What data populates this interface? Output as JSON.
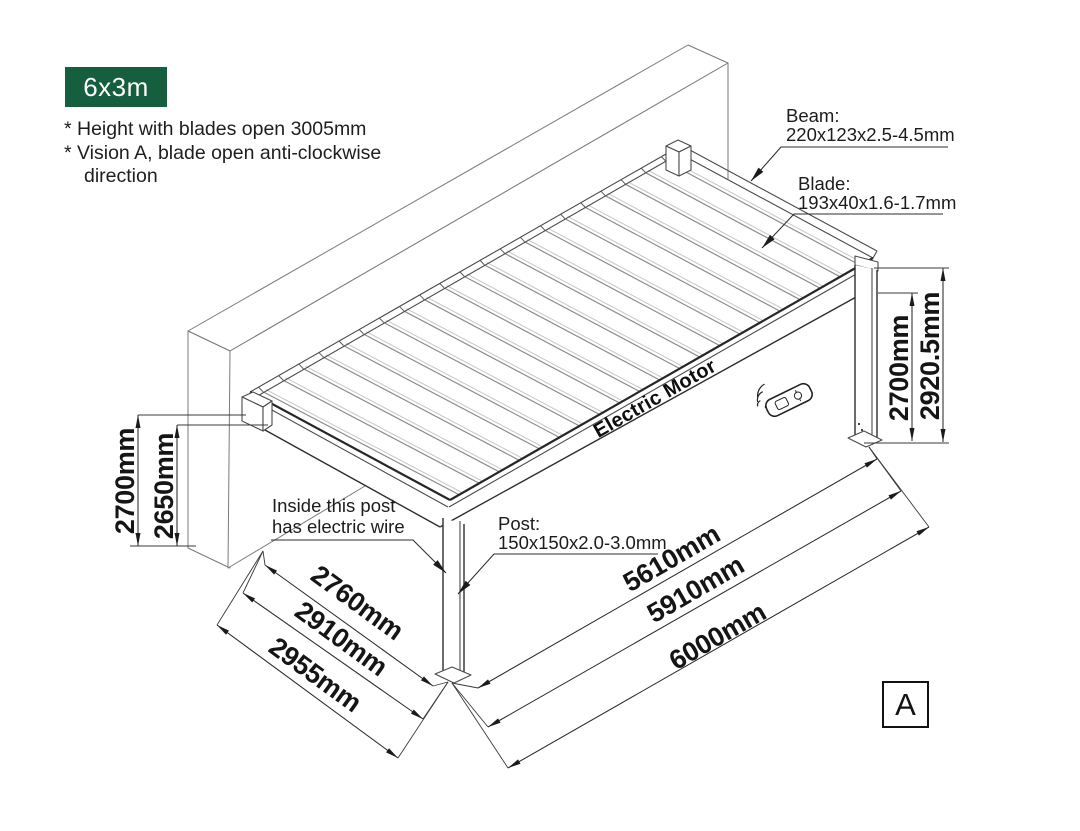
{
  "badge": {
    "label": "6x3m"
  },
  "notes": {
    "line1": "* Height with blades open 3005mm",
    "line2": "* Vision A, blade open anti-clockwise",
    "line3": "direction"
  },
  "callouts": {
    "beam_title": "Beam:",
    "beam_spec": "220x123x2.5-4.5mm",
    "blade_title": "Blade:",
    "blade_spec": "193x40x1.6-1.7mm",
    "post_title": "Post:",
    "post_spec": "150x150x2.0-3.0mm",
    "wire_line1": "Inside this post",
    "wire_line2": "has electric wire",
    "motor": "Electric Motor"
  },
  "dimensions": {
    "left_wall_height_outer": "2700mm",
    "left_wall_height_inner": "2650mm",
    "right_height_inner": "2700mm",
    "right_height_outer": "2920.5mm",
    "depth_inner": "2760mm",
    "depth_mid": "2910mm",
    "depth_outer": "2955mm",
    "length_inner": "5610mm",
    "length_mid": "5910mm",
    "length_outer": "6000mm"
  },
  "view_label": "A",
  "icons": {
    "remote": "wireless-remote-control-icon"
  },
  "colors": {
    "badge_bg": "#155e3e",
    "badge_fg": "#ffffff",
    "line_dark": "#262626",
    "line_mid": "#4a4a4a",
    "text": "#151515"
  }
}
